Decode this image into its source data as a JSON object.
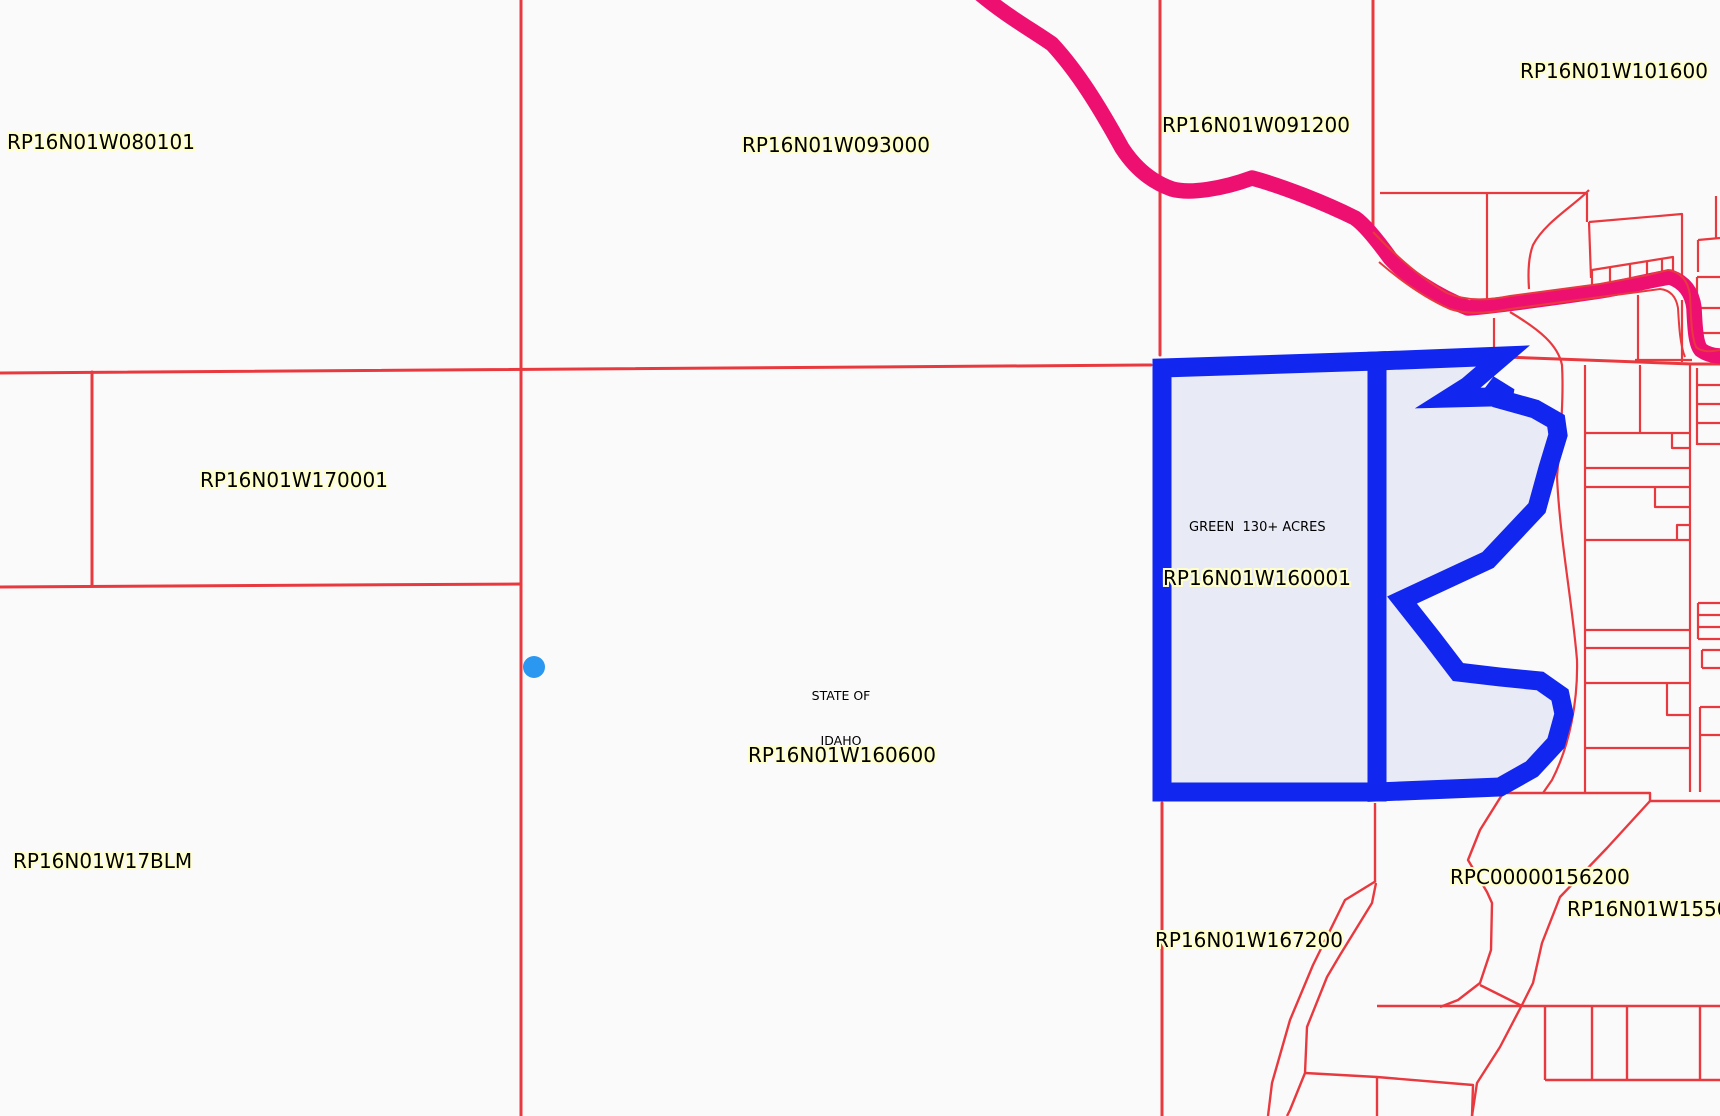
{
  "map": {
    "background_color": "#fbfafb",
    "parcel_line_color": "#e8393f",
    "road_color": "#ee1070",
    "highlight_stroke_color": "#1126ee",
    "highlight_fill_color": "#e8eaf6",
    "marker_color": "#2a97f0",
    "label_halo_color": "#ffffcb",
    "labels": [
      {
        "text": "RP16N01W080101"
      },
      {
        "text": "RP16N01W093000"
      },
      {
        "text": "RP16N01W091200"
      },
      {
        "text": "RP16N01W101600"
      },
      {
        "text": "RP16N01W170001"
      },
      {
        "text": "RP16N01W17BLM"
      },
      {
        "text": "RP16N01W160600"
      },
      {
        "text": "RP16N01W167200"
      },
      {
        "text": "RPC00000156200"
      },
      {
        "text": "RP16N01W15500"
      }
    ],
    "highlight": {
      "note": "GREEN  130+ ACRES",
      "parcel_id": "RP16N01W160001"
    },
    "state_land_label": {
      "line1": "STATE OF",
      "line2": "IDAHO"
    }
  }
}
